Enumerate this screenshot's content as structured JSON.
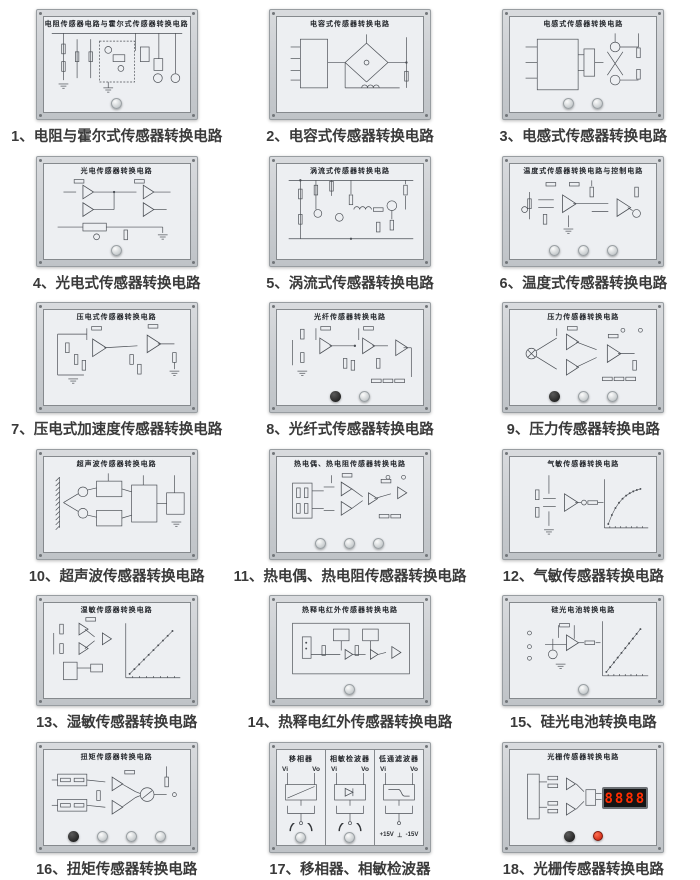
{
  "page": {
    "description_note": "",
    "colors": {
      "background": "#ffffff",
      "panel_frame": "#c9ccd0",
      "panel_plate": "#edeff2",
      "schematic_line": "#4a4e54",
      "caption_text": "#3a3a3a",
      "display_background": "#141414",
      "display_digits": "#ff2c00",
      "red_button": "#c21806"
    }
  },
  "panels": [
    {
      "id": 1,
      "title": "电阻传感器电路与霍尔式传感器转换电路",
      "caption": "1、电阻与霍尔式传感器转换电路",
      "knobs": [
        "light"
      ]
    },
    {
      "id": 2,
      "title": "电容式传感器转换电路",
      "caption": "2、电容式传感器转换电路",
      "knobs": []
    },
    {
      "id": 3,
      "title": "电感式传感器转换电路",
      "caption": "3、电感式传感器转换电路",
      "knobs": [
        "light",
        "light"
      ]
    },
    {
      "id": 4,
      "title": "光电传感器转换电路",
      "caption": "4、光电式传感器转换电路",
      "knobs": [
        "light"
      ]
    },
    {
      "id": 5,
      "title": "涡流式传感器转换电路",
      "caption": "5、涡流式传感器转换电路",
      "knobs": []
    },
    {
      "id": 6,
      "title": "温度式传感器转换电路与控制电路",
      "caption": "6、温度式传感器转换电路",
      "knobs": [
        "light",
        "light",
        "light"
      ]
    },
    {
      "id": 7,
      "title": "压电式传感器转换电路",
      "caption": "7、压电式加速度传感器转换电路",
      "knobs": []
    },
    {
      "id": 8,
      "title": "光纤传感器转换电路",
      "caption": "8、光纤式传感器转换电路",
      "knobs": [
        "dark",
        "light"
      ]
    },
    {
      "id": 9,
      "title": "压力传感器转换电路",
      "caption": "9、压力传感器转换电路",
      "knobs": [
        "dark",
        "light",
        "light"
      ]
    },
    {
      "id": 10,
      "title": "超声波传感器转换电路",
      "caption": "10、超声波传感器转换电路",
      "knobs": []
    },
    {
      "id": 11,
      "title": "热电偶、热电阻传感器转换电路",
      "caption": "11、热电偶、热电阻传感器转换电路",
      "knobs": [
        "light",
        "light",
        "light"
      ]
    },
    {
      "id": 12,
      "title": "气敏传感器转换电路",
      "caption": "12、气敏传感器转换电路",
      "knobs": []
    },
    {
      "id": 13,
      "title": "湿敏传感器转换电路",
      "caption": "13、湿敏传感器转换电路",
      "knobs": []
    },
    {
      "id": 14,
      "title": "热释电红外传感器转换电路",
      "caption": "14、热释电红外传感器转换电路",
      "knobs": [
        "light"
      ]
    },
    {
      "id": 15,
      "title": "硅光电池转换电路",
      "caption": "15、硅光电池转换电路",
      "knobs": [
        "light"
      ]
    },
    {
      "id": 16,
      "title": "扭矩传感器转换电路",
      "caption": "16、扭矩传感器转换电路",
      "knobs": [
        "dark",
        "light",
        "light",
        "light"
      ]
    },
    {
      "id": 17,
      "title": "",
      "caption": "17、移相器、相敏检波器",
      "knobs": [],
      "sections": [
        "移相器",
        "相敏检波器",
        "低通滤波器"
      ],
      "terminal_labels": [
        "Vi",
        "Vo"
      ],
      "power_labels": [
        "+15V",
        "⊥",
        "-15V"
      ]
    },
    {
      "id": 18,
      "title": "光栅传感器转换电路",
      "caption": "18、光栅传感器转换电路",
      "knobs": [
        "dark",
        "red"
      ],
      "display_value": "8888"
    }
  ]
}
